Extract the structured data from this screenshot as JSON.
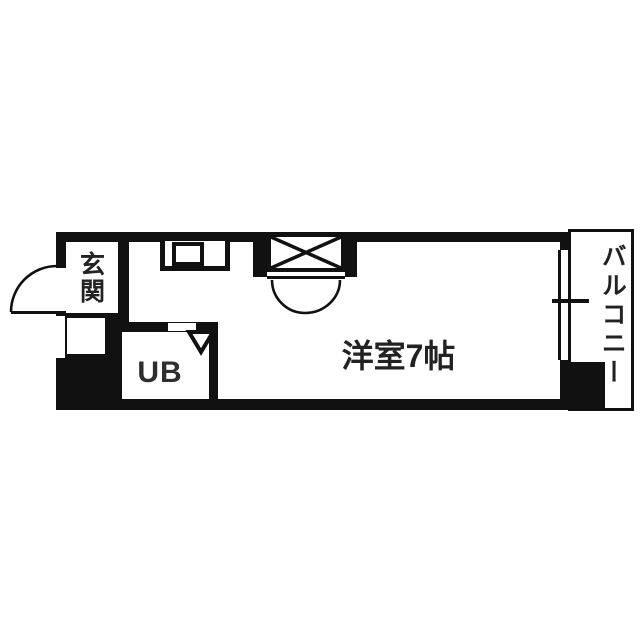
{
  "page": {
    "background": "#ffffff",
    "description_labels_only": "Japanese apartment floor plan"
  },
  "floorplan": {
    "colors": {
      "wall": "#111111",
      "label_text": "#222222",
      "ub_text": "#2e2e2e",
      "floor": "#ffffff"
    },
    "rooms": {
      "entrance": {
        "label": "玄関"
      },
      "unit_bath": {
        "label": "UB"
      },
      "main_room": {
        "label": "洋室7帖"
      },
      "balcony": {
        "label": "バルコニー"
      }
    },
    "fixtures": {
      "entrance_door": "entrance-door-swing-icon",
      "kitchen_counter": "kitchen-counter-sink-icon",
      "closet": "closet-x-symbol-icon",
      "closet_doors": "double-door-swing-icon",
      "bath_door": "folding-door-triangle-icon",
      "window": "sliding-window-symbol-icon"
    }
  }
}
